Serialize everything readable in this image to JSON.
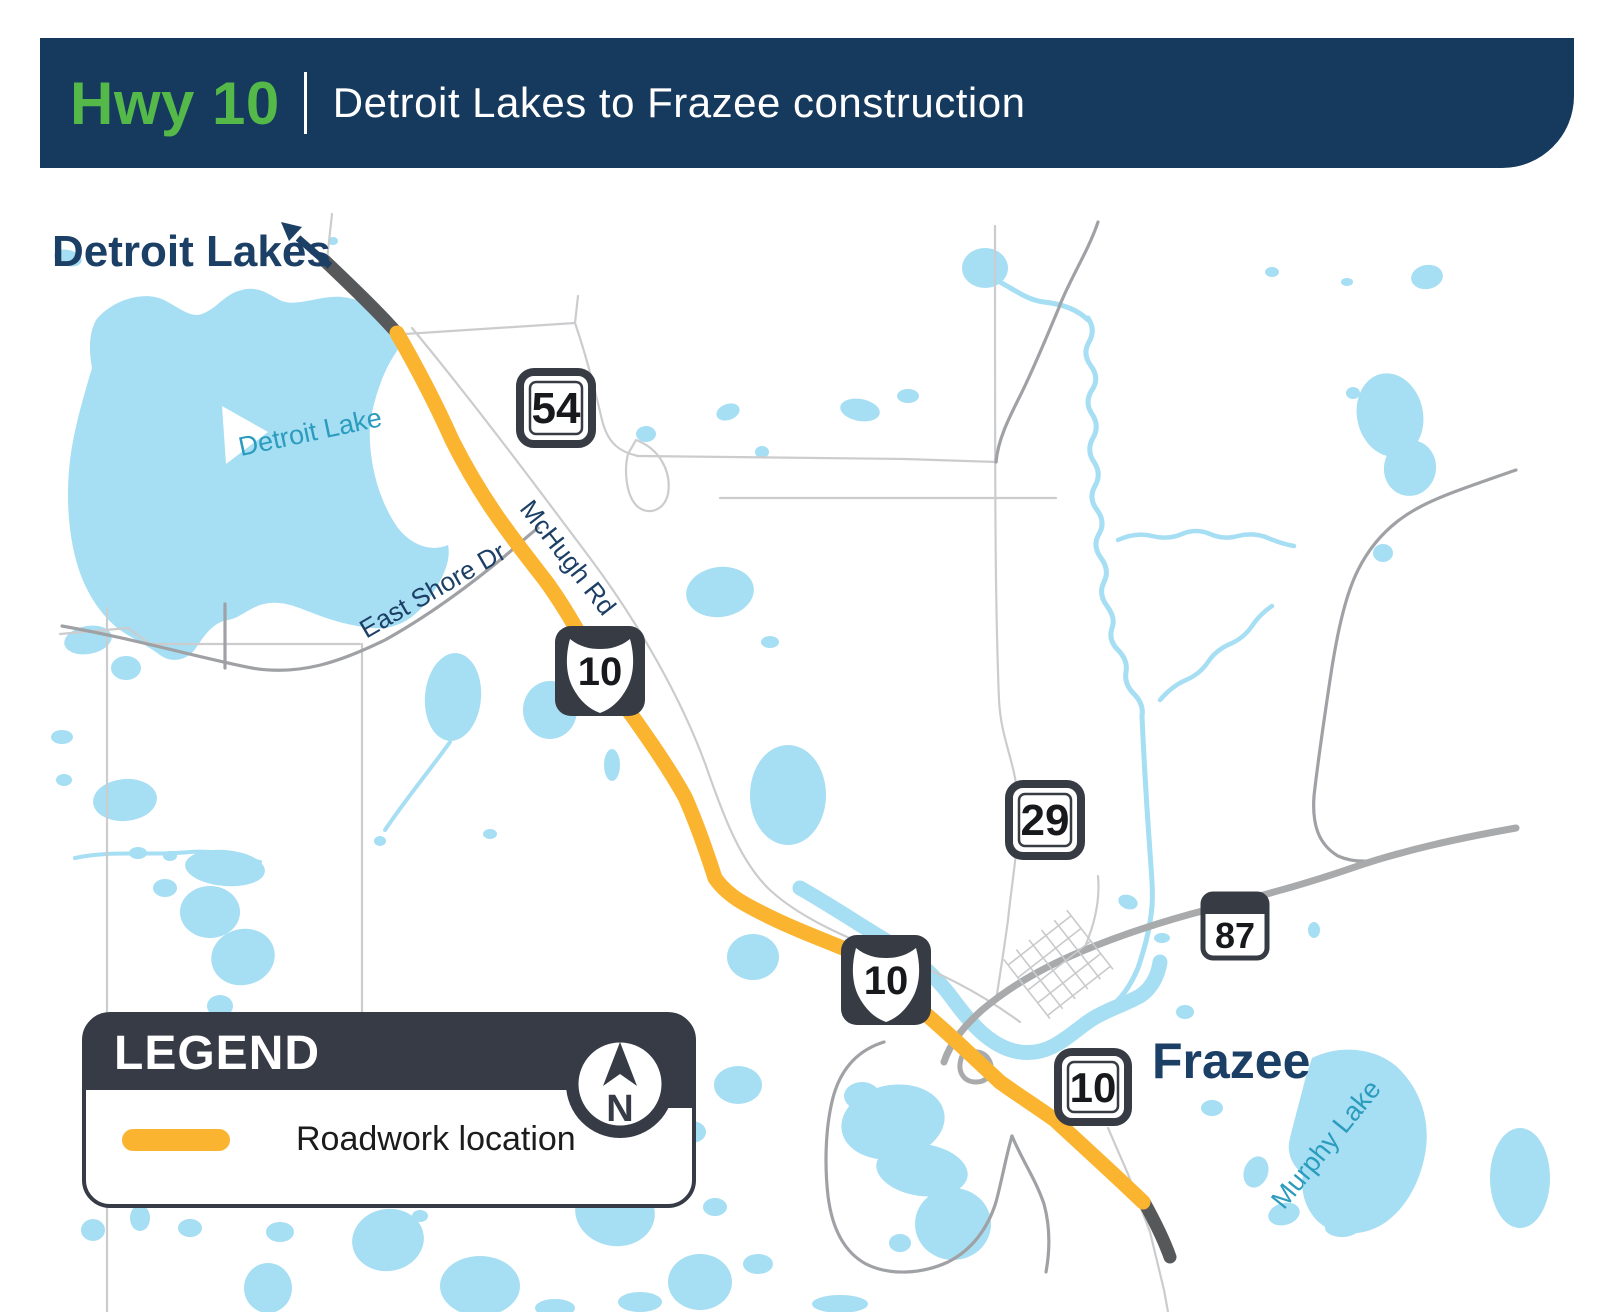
{
  "header": {
    "route": "Hwy 10",
    "subtitle": "Detroit Lakes to Frazee construction"
  },
  "map": {
    "city_nw": "Detroit Lakes",
    "city_se": "Frazee",
    "lake_label": "Detroit Lake",
    "murphy_label": "Murphy Lake",
    "road_east_shore": "East Shore Dr",
    "road_mchugh": "McHugh Rd",
    "shields": {
      "s54": "54",
      "us10_north": "10",
      "s29": "29",
      "us10_mid": "10",
      "s10_frazee": "10",
      "s87": "87"
    }
  },
  "legend": {
    "title": "LEGEND",
    "north": "N",
    "items": [
      {
        "swatch_color": "#FBB42F",
        "label": "Roadwork location"
      }
    ]
  },
  "colors": {
    "banner_navy": "#16395E",
    "accent_green": "#54B948",
    "lake_blue": "#A6DEF3",
    "roadwork_yellow": "#FBB42F",
    "road_dark": "#57585A",
    "road_thick": "#A8AAAC",
    "road_medium": "#9FA1A4",
    "road_thin": "#CBCCCE",
    "label_navy": "#1C3F66",
    "label_teal": "#2B9CBD",
    "panel_slate": "#363B46"
  }
}
